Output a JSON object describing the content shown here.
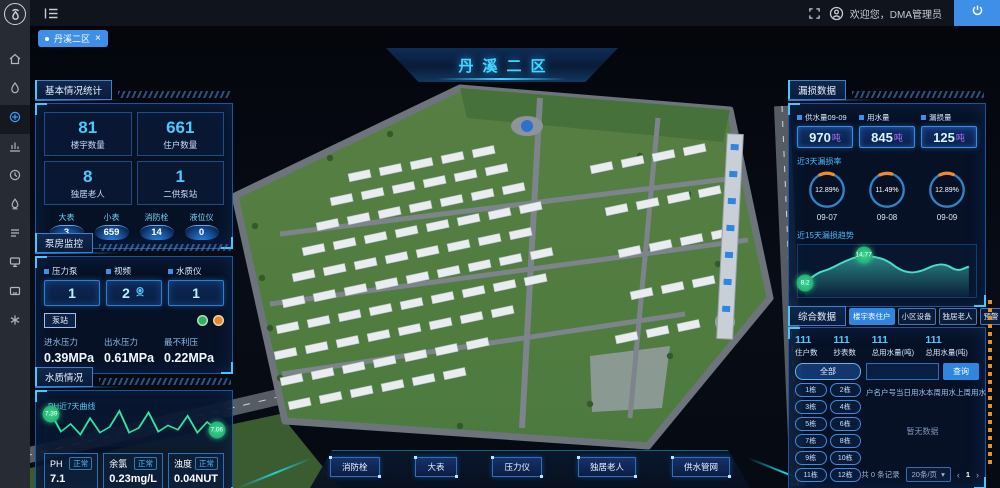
{
  "topbar": {
    "welcome_text": "欢迎您，DMA管理员",
    "tab_label": "丹溪二区"
  },
  "icons": {
    "close": "×",
    "caret": "▾",
    "prev": "‹",
    "next": "›"
  },
  "sidebar": {
    "icons": [
      {
        "name": "home-icon"
      },
      {
        "name": "water-drop-icon"
      },
      {
        "name": "dashboard-icon",
        "active": true
      },
      {
        "name": "chart-icon"
      },
      {
        "name": "history-icon"
      },
      {
        "name": "quality-icon"
      },
      {
        "name": "list-icon"
      },
      {
        "name": "monitor-icon"
      },
      {
        "name": "message-icon"
      },
      {
        "name": "tools-icon"
      }
    ]
  },
  "scene": {
    "title": "丹溪二区",
    "bottom_buttons": [
      "消防栓",
      "大表",
      "压力仪",
      "独居老人",
      "供水管网"
    ]
  },
  "basic_panel": {
    "title": "基本情况统计",
    "stats": [
      {
        "value": "81",
        "label": "楼宇数量"
      },
      {
        "value": "661",
        "label": "住户数量"
      },
      {
        "value": "8",
        "label": "独居老人"
      },
      {
        "value": "1",
        "label": "二供泵站"
      }
    ],
    "meters": [
      {
        "label": "大表",
        "value": "3"
      },
      {
        "label": "小表",
        "value": "659"
      },
      {
        "label": "消防栓",
        "value": "14"
      },
      {
        "label": "液位仪",
        "value": "0"
      }
    ]
  },
  "pump_panel": {
    "title": "泵房监控",
    "devices": [
      {
        "label": "压力泵",
        "value": "1"
      },
      {
        "label": "视频",
        "value": "2"
      },
      {
        "label": "水质仪",
        "value": "1"
      }
    ],
    "station_badge": "泵站",
    "pressures": [
      {
        "label": "进水压力",
        "value": "0.39MPa"
      },
      {
        "label": "出水压力",
        "value": "0.61MPa"
      },
      {
        "label": "最不利压",
        "value": "0.22MPa"
      }
    ]
  },
  "quality_panel": {
    "title": "水质情况",
    "readings": [
      {
        "label": "PH",
        "status": "正常",
        "value": "7.1"
      },
      {
        "label": "余氯",
        "status": "正常",
        "value": "0.23mg/L"
      },
      {
        "label": "浊度",
        "status": "正常",
        "value": "0.04NUT"
      }
    ]
  },
  "leakage_panel": {
    "title": "漏损数据",
    "boxes": [
      {
        "label": "供水量09-09",
        "value": "970",
        "unit": "吨"
      },
      {
        "label": "用水量",
        "value": "845",
        "unit": "吨"
      },
      {
        "label": "漏损量",
        "value": "125",
        "unit": "吨"
      }
    ]
  },
  "comprehensive_panel": {
    "title": "综合数据",
    "tabs": [
      {
        "label": "楼宇表住户",
        "active": true
      },
      {
        "label": "小区设备",
        "active": false
      },
      {
        "label": "独居老人",
        "active": false
      },
      {
        "label": "预警",
        "active": false
      }
    ],
    "stats": [
      {
        "value": "111",
        "label": "住户数"
      },
      {
        "value": "111",
        "label": "抄表数"
      },
      {
        "value": "111",
        "label": "总用水量(吨)"
      },
      {
        "value": "111",
        "label": "总用水量(吨)"
      }
    ],
    "filter_all": "全部",
    "buildings": [
      "1栋",
      "2栋",
      "3栋",
      "4栋",
      "5栋",
      "6栋",
      "7栋",
      "8栋",
      "9栋",
      "10栋",
      "11栋",
      "12栋"
    ],
    "toggle_label": "定位开启",
    "search_value": "",
    "search_button": "查询",
    "table_headers": [
      "户名",
      "户号",
      "当日用水",
      "本周用水",
      "上周用水"
    ],
    "empty_text": "暂无数据",
    "pagination": {
      "total": "共 0 条记录",
      "page_size": "20条/页",
      "page": "1"
    }
  },
  "chart_data": [
    {
      "type": "line",
      "title": "PH近7天曲线",
      "ylabel": "PH",
      "ylim": [
        6.8,
        7.6
      ],
      "color": "#2ee6a0",
      "values": [
        7.39,
        7.02,
        7.18,
        6.96,
        7.3,
        7.0,
        7.12,
        7.45,
        7.0,
        7.1,
        7.42,
        7.02,
        7.15,
        7.06,
        7.35,
        7.0,
        7.22,
        7.06
      ],
      "markers": [
        {
          "index": 0,
          "label": "7.39"
        },
        {
          "index": 17,
          "label": "7.06"
        }
      ]
    },
    {
      "type": "area",
      "title": "近15天漏损趋势",
      "ylim": [
        6,
        16
      ],
      "color": "#45e0c8",
      "values": [
        8.2,
        10.6,
        11.3,
        12.8,
        14.1,
        14.77,
        14.4,
        13.6,
        11.4,
        10.5,
        11.0,
        12.4,
        12.7,
        10.9,
        12.1
      ],
      "markers": [
        {
          "index": 0,
          "label": "8.2"
        },
        {
          "index": 5,
          "label": "14.77"
        }
      ]
    },
    {
      "type": "gauge",
      "title": "近3天漏损率",
      "items": [
        {
          "label": "12.89%",
          "percent": 12.89,
          "date": "09-07"
        },
        {
          "label": "11.49%",
          "percent": 11.49,
          "date": "09-08"
        },
        {
          "label": "12.89%",
          "percent": 12.89,
          "date": "09-09"
        }
      ]
    }
  ]
}
